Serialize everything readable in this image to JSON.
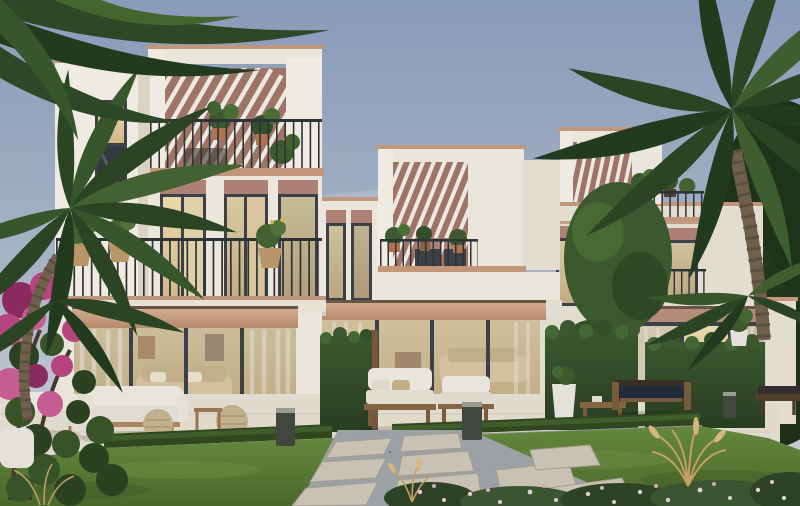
{
  "image": {
    "kind": "architectural-exterior-rendering",
    "subject": "Row of three modern Mediterranean-style townhouses with rooftop pergola terraces, plant-filled balconies, warm-lit glass interiors and a landscaped front garden",
    "setting": "late-afternoon dusk light, soft blue-grey sky",
    "width_px": 800,
    "height_px": 506
  },
  "palette": {
    "sky_top": "#8CA0BE",
    "sky_mid": "#AEB9CB",
    "sky_bottom": "#CBD0D9",
    "wall_cream": "#F2EDE2",
    "wall_bright": "#F7F2E8",
    "wall_shadow": "#E1D9C9",
    "wall_dim": "#EAE3D5",
    "pergola_pink": "#A3766A",
    "pergola_pink_dark": "#8F6459",
    "coping_terracotta": "#C79A7C",
    "window_header_pink": "#B28578",
    "wood_header_light": "#DCB795",
    "wood_header_dark": "#BC8E6F",
    "window_frame": "#3E4348",
    "glass_warm": "#EFDFAF",
    "glass_warm_deep": "#D9BE8C",
    "glass_dark": "#34393E",
    "railing_iron": "#2F3438",
    "interior_beige": "#D9C6A3",
    "curtain_white": "#EDE8DD",
    "hedge_green": "#3C5A2E",
    "hedge_dark": "#2A3F21",
    "lawn_green": "#668C3C",
    "lawn_dark": "#4C6A2C",
    "boxwood": "#33491F",
    "palm_green": "#2C4724",
    "palm_green_light": "#446631",
    "palm_trunk": "#72634C",
    "tree_dark": "#24381E",
    "bougainvillea": "#BB4680",
    "bougainvillea_deep": "#8E2C60",
    "patio_stone": "#E7E1D4",
    "paver": "#CEC7B8",
    "gravel": "#9FA6A8",
    "cushion_white": "#F0ECE2",
    "cushion_navy": "#232C3A",
    "wood_furniture": "#8A6844",
    "rattan": "#C8B491",
    "ornamental_grass_tan": "#CEA96C",
    "planter_white": "#EBE8E0",
    "bollard_grey": "#43483F"
  },
  "buildings": {
    "left_townhouse": {
      "storeys": 3,
      "features": [
        "rooftop terrace with white louvered pergola over dusty-pink feature wall",
        "terracotta coping on parapets",
        "black metal rooftop railing with potted plants",
        "second-floor balcony with iron railing and hanging rattan planters with yellow flowers",
        "tall windows with pink header panels and warm interior light",
        "left tower with single lit window",
        "ground floor full-width sliding glass wall with timber header band, sheer curtains, beige sofa and wall art inside"
      ]
    },
    "middle_townhouse": {
      "storeys": 3,
      "features": [
        "set-back volume with louvered pergola and pink feature wall",
        "balcony with railing and potted plants",
        "tall pink-headed windows",
        "ground floor glass sliding doors with timber header and warm lit interior",
        "green hedge privacy walls flanking the patio"
      ]
    },
    "right_townhouse": {
      "storeys": 3,
      "features": [
        "corner rooftop pergola with pink wall",
        "roof terrace railing with plants",
        "second-floor windows with pink headers and small balcony",
        "ground floor windows with curtains behind tall hedge wall",
        "white garden boundary wall"
      ]
    }
  },
  "landscape": {
    "lawn": "manicured green lawn panels left and right of a paved walk",
    "path": "large square stone pavers set in grey pebble gravel, running diagonally to the patios",
    "low_hedge": "clipped boxwood strip separating patio from lawn",
    "flower_bed": "bed of small pale pink and white flowers along the bottom right",
    "ornamental_grass": "tan fountain-grass plumes in the lawn and beds",
    "bougainvillea": "magenta bougainvillea shrub in the lower left corner",
    "palms": "large palm fronds entering top left, full palm left of the houses, tall palm and dark trees on the right",
    "lighting": "three dark grey bollard path lights"
  },
  "furniture": {
    "left_patio": [
      "white outdoor sofa with wood frame",
      "white armchair",
      "two woven rattan poufs",
      "rattan side table"
    ],
    "middle_patio": [
      "timber lounge chairs with white cushions",
      "timber coffee table",
      "tall white planter vase"
    ],
    "right_patio": [
      "timber bench with dark navy cushion",
      "white pot with shrub"
    ]
  }
}
